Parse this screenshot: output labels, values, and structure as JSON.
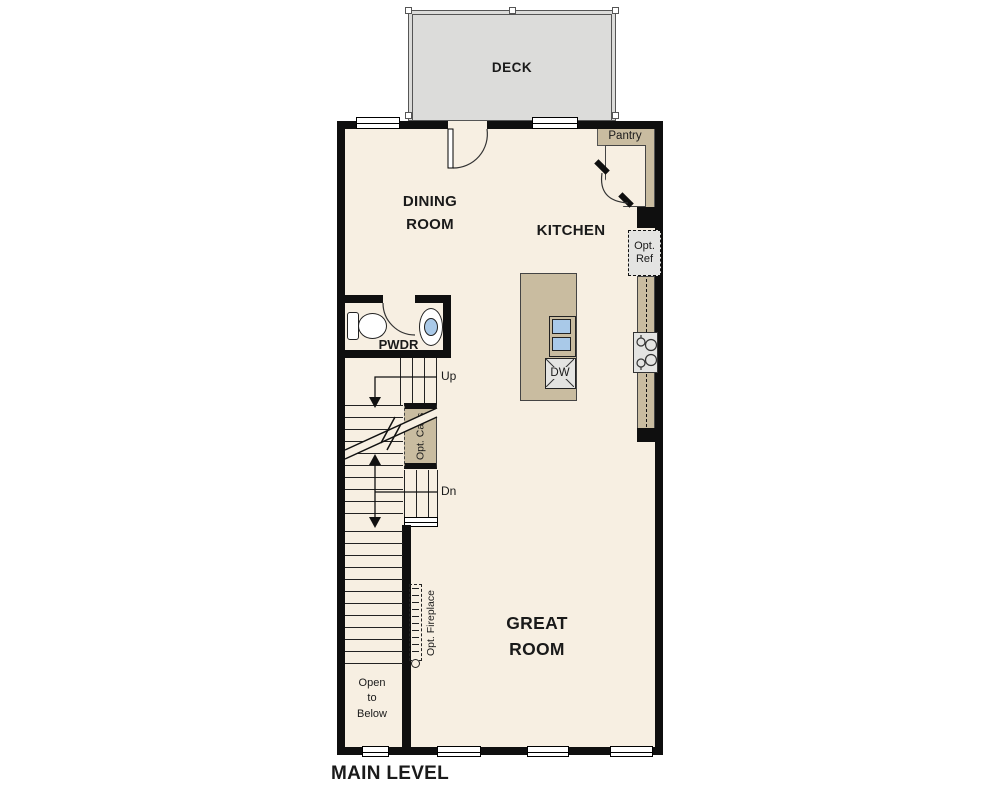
{
  "colors": {
    "wall": "#0f0f0f",
    "floor": "#f7efe2",
    "tan": "#c9bca0",
    "deck": "#dcdcda",
    "appliance": "#e4e4e2",
    "sink": "#a9c9e8",
    "line": "#222222",
    "ink": "#1a1a1a"
  },
  "labels": {
    "deck": "DECK",
    "dining_room": "DINING ROOM",
    "kitchen": "KITCHEN",
    "pantry": "Pantry",
    "pwdr": "PWDR",
    "great_room": "GREAT ROOM",
    "main_level": "MAIN LEVEL",
    "up": "Up",
    "dn": "Dn",
    "opt_ref": "Opt. Ref",
    "dw": "DW",
    "opt_cabs": "Opt. Cabs",
    "opt_fireplace": "Opt. Fireplace",
    "open_to_below": "Open\nto\nBelow"
  }
}
